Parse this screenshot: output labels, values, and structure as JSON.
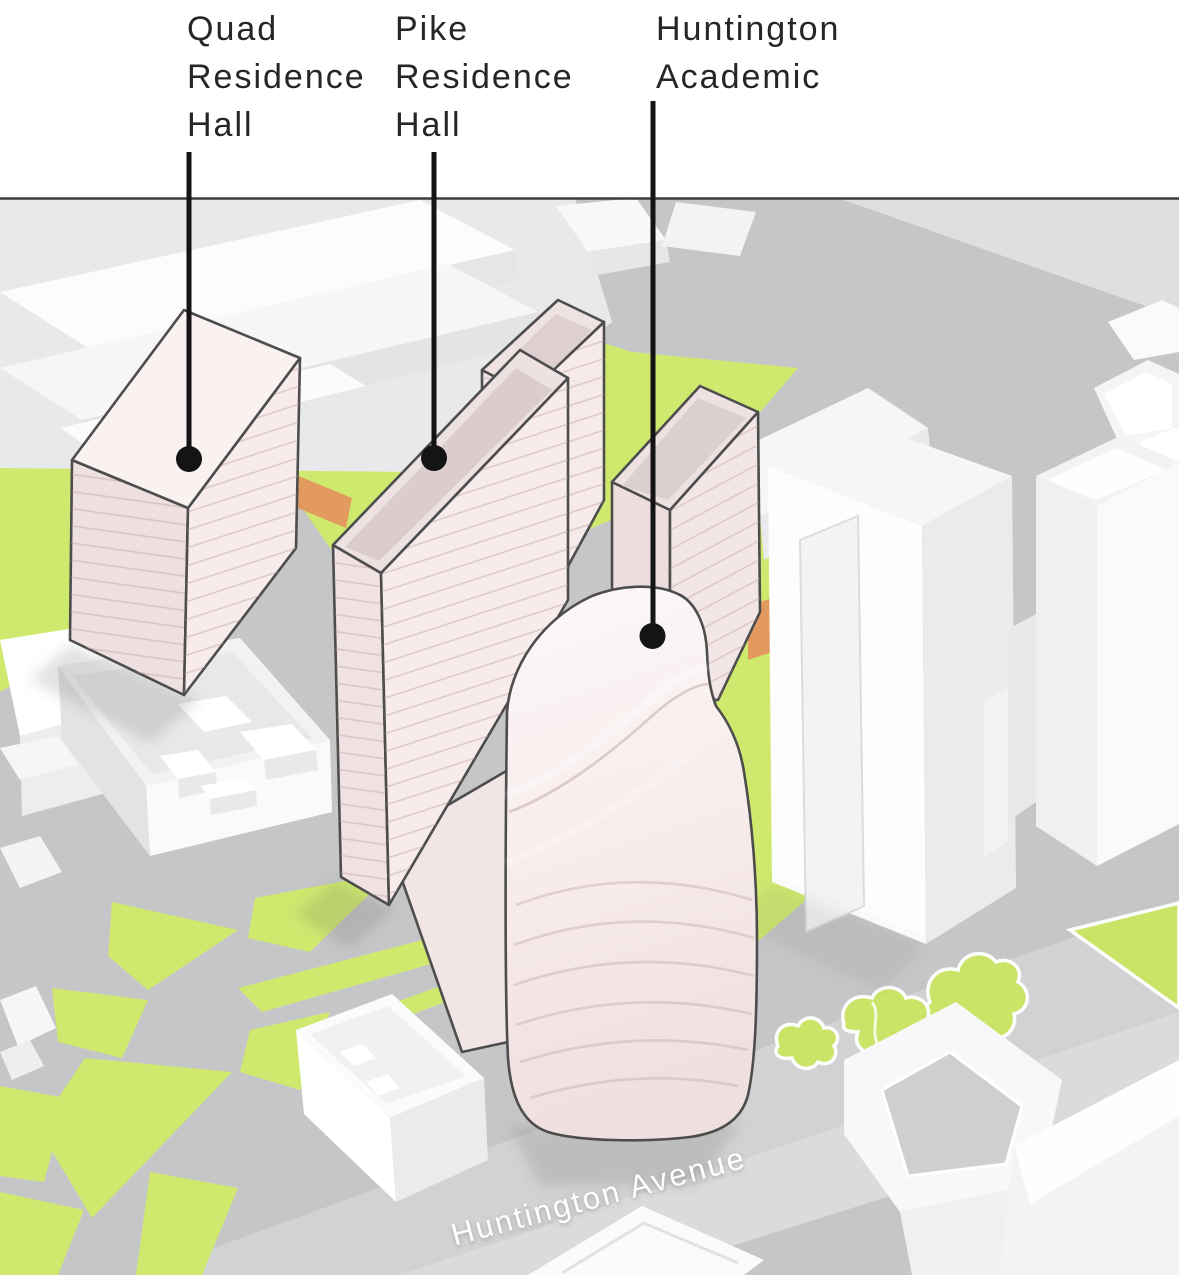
{
  "callouts": [
    {
      "label": "Quad\nResidence\nHall"
    },
    {
      "label": "Pike\nResidence\nHall"
    },
    {
      "label": "Huntington\nAcademic"
    }
  ],
  "street_label": "Huntington Avenue",
  "colors": {
    "street_gray": "#c6c6c8",
    "sidewalk_gray": "#dfdfe1",
    "avenue_gray": "#d2d2d4",
    "park_green": "#cfe96f",
    "path_orange": "#e39a5f",
    "highlight_pink": "#f7ebeb",
    "building_white": "#fafafc",
    "outline_dark": "#4d4d4d",
    "label_text": "#262626",
    "leader_line": "#141414",
    "street_label_text": "#ffffff"
  }
}
